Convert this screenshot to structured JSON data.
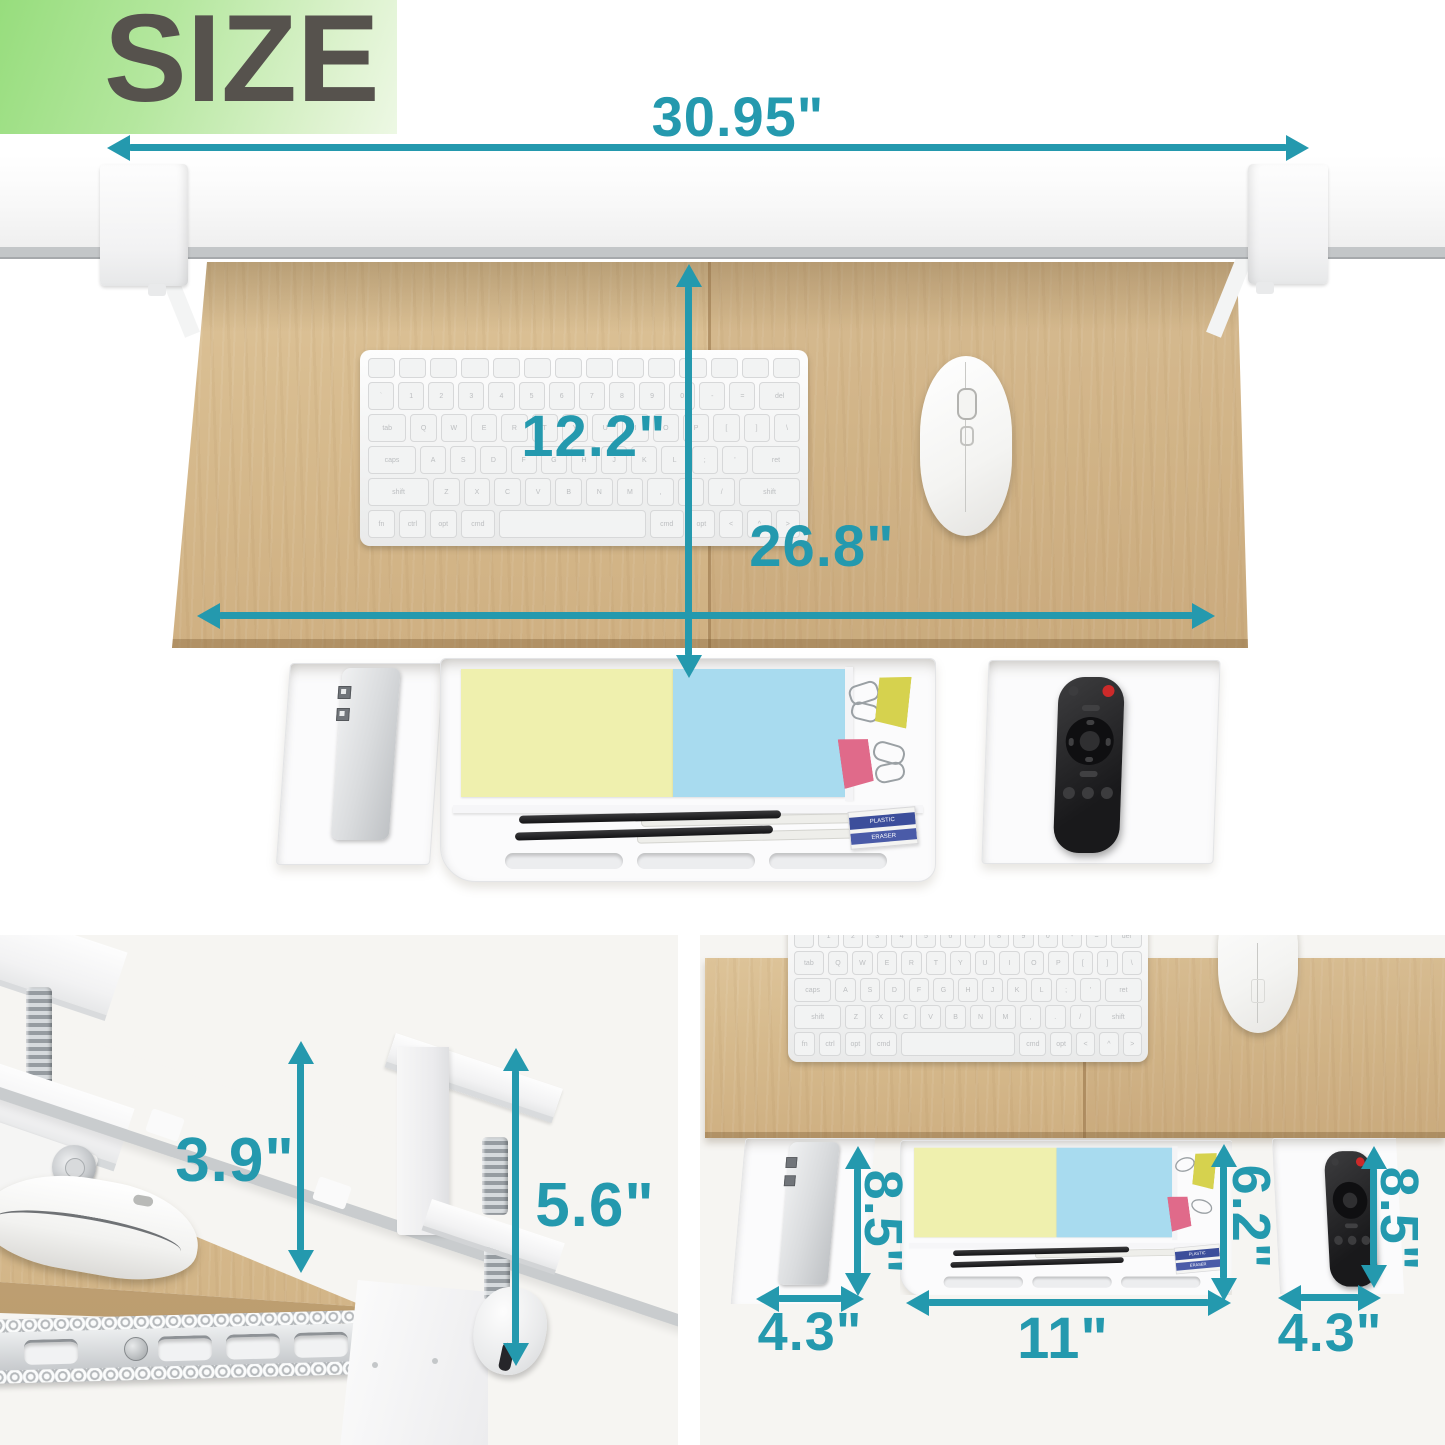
{
  "title": "SIZE",
  "colors": {
    "accent": "#2499ae",
    "wood": "#d6ba8d",
    "title_text": "#56524d",
    "title_bg_start": "#97dd7d",
    "title_bg_end": "#e9f7df",
    "note_yellow": "#eff0ae",
    "note_blue": "#a8dbef",
    "clip_yellow": "#d6d24e",
    "clip_pink": "#e06a8a",
    "eraser_band": "#3c4e9b",
    "remote_power": "#cc2a2a"
  },
  "labels": {
    "desk_width": "30.95\"",
    "tray_depth": "12.2\"",
    "tray_width": "26.8\"",
    "clearance": "3.9\"",
    "clamp_height": "5.6\"",
    "left_drawer_depth": "8.5\"",
    "left_drawer_width": "4.3\"",
    "center_drawer_depth": "6.2\"",
    "center_drawer_width": "11\"",
    "right_drawer_depth": "8.5\"",
    "right_drawer_width": "4.3\""
  },
  "eraser": {
    "line1": "PLASTIC",
    "line2": "ERASER"
  },
  "keyboard": {
    "rows": [
      [
        [
          "",
          1
        ],
        [
          "",
          1
        ],
        [
          "",
          1
        ],
        [
          "",
          1
        ],
        [
          "",
          1
        ],
        [
          "",
          1
        ],
        [
          "",
          1
        ],
        [
          "",
          1
        ],
        [
          "",
          1
        ],
        [
          "",
          1
        ],
        [
          "",
          1
        ],
        [
          "",
          1
        ],
        [
          "",
          1
        ],
        [
          "",
          1
        ]
      ],
      [
        [
          "`",
          1
        ],
        [
          "1",
          1
        ],
        [
          "2",
          1
        ],
        [
          "3",
          1
        ],
        [
          "4",
          1
        ],
        [
          "5",
          1
        ],
        [
          "6",
          1
        ],
        [
          "7",
          1
        ],
        [
          "8",
          1
        ],
        [
          "9",
          1
        ],
        [
          "0",
          1
        ],
        [
          "-",
          1
        ],
        [
          "=",
          1
        ],
        [
          "del",
          1.6
        ]
      ],
      [
        [
          "tab",
          1.5
        ],
        [
          "Q",
          1
        ],
        [
          "W",
          1
        ],
        [
          "E",
          1
        ],
        [
          "R",
          1
        ],
        [
          "T",
          1
        ],
        [
          "Y",
          1
        ],
        [
          "U",
          1
        ],
        [
          "I",
          1
        ],
        [
          "O",
          1
        ],
        [
          "P",
          1
        ],
        [
          "[",
          1
        ],
        [
          "]",
          1
        ],
        [
          "\\",
          1
        ]
      ],
      [
        [
          "caps",
          1.9
        ],
        [
          "A",
          1
        ],
        [
          "S",
          1
        ],
        [
          "D",
          1
        ],
        [
          "F",
          1
        ],
        [
          "G",
          1
        ],
        [
          "H",
          1
        ],
        [
          "J",
          1
        ],
        [
          "K",
          1
        ],
        [
          "L",
          1
        ],
        [
          ";",
          1
        ],
        [
          "'",
          1
        ],
        [
          "ret",
          1.9
        ]
      ],
      [
        [
          "shift",
          2.4
        ],
        [
          "Z",
          1
        ],
        [
          "X",
          1
        ],
        [
          "C",
          1
        ],
        [
          "V",
          1
        ],
        [
          "B",
          1
        ],
        [
          "N",
          1
        ],
        [
          "M",
          1
        ],
        [
          ",",
          1
        ],
        [
          ".",
          1
        ],
        [
          "/",
          1
        ],
        [
          "shift",
          2.4
        ]
      ],
      [
        [
          "fn",
          1
        ],
        [
          "ctrl",
          1
        ],
        [
          "opt",
          1
        ],
        [
          "cmd",
          1.3
        ],
        [
          "",
          5.8
        ],
        [
          "cmd",
          1.3
        ],
        [
          "opt",
          1
        ],
        [
          "<",
          0.9
        ],
        [
          "^",
          0.9
        ],
        [
          ">",
          0.9
        ]
      ]
    ]
  }
}
